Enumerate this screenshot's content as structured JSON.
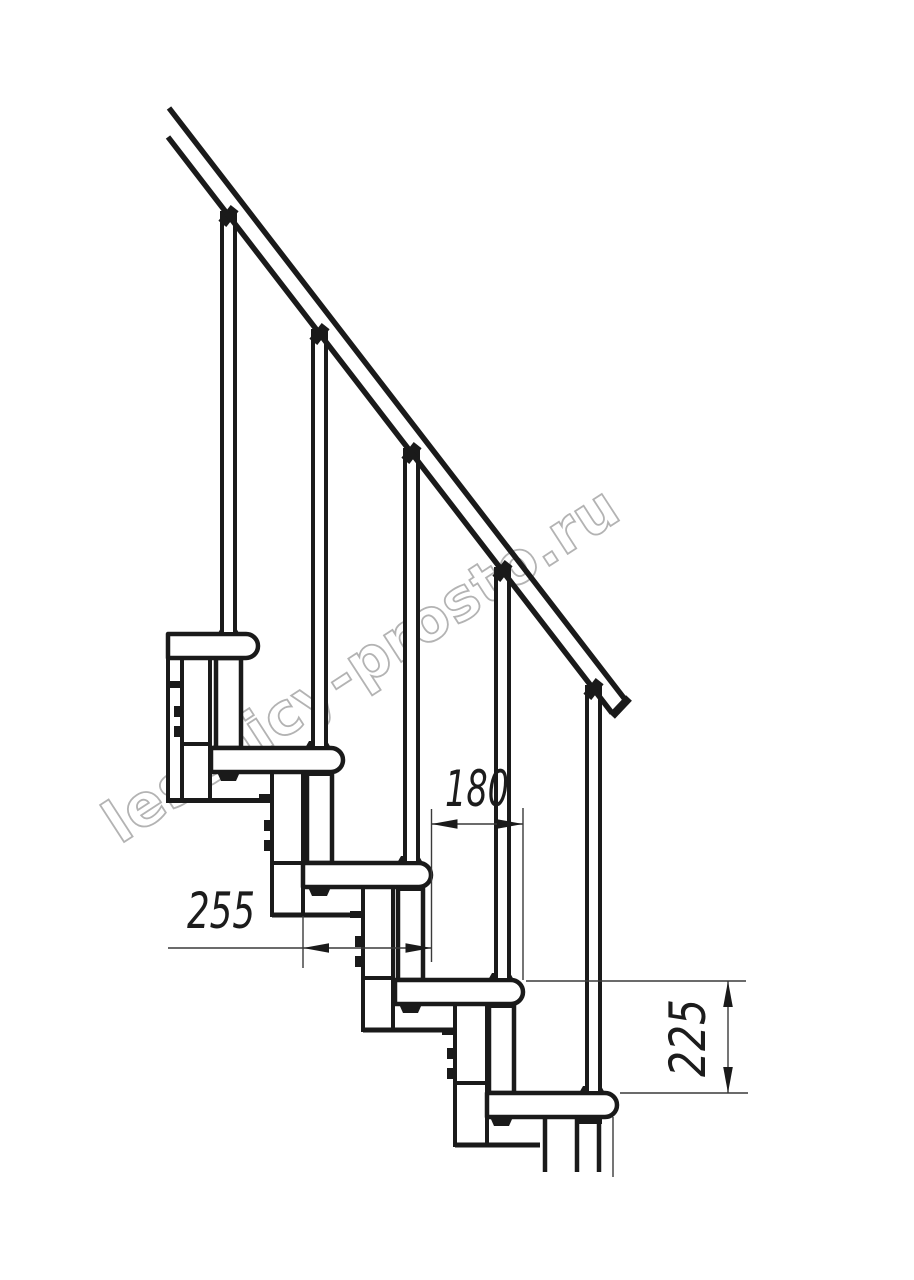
{
  "watermark": {
    "text": "lestnicy-prosto.ru"
  },
  "dimensions": {
    "step_offset": {
      "value": "180",
      "meaning": "horizontal offset between tread noses"
    },
    "tread_depth": {
      "value": "255",
      "meaning": "tread depth"
    },
    "step_rise": {
      "value": "225",
      "meaning": "vertical rise between treads"
    }
  },
  "drawing": {
    "subject": "modular staircase side view",
    "tread_count_visible": 5
  },
  "colors": {
    "line": "#1a1a1a",
    "thin_line": "#3a3a3a",
    "watermark_outline": "#b3b3b3",
    "background": "#ffffff"
  }
}
